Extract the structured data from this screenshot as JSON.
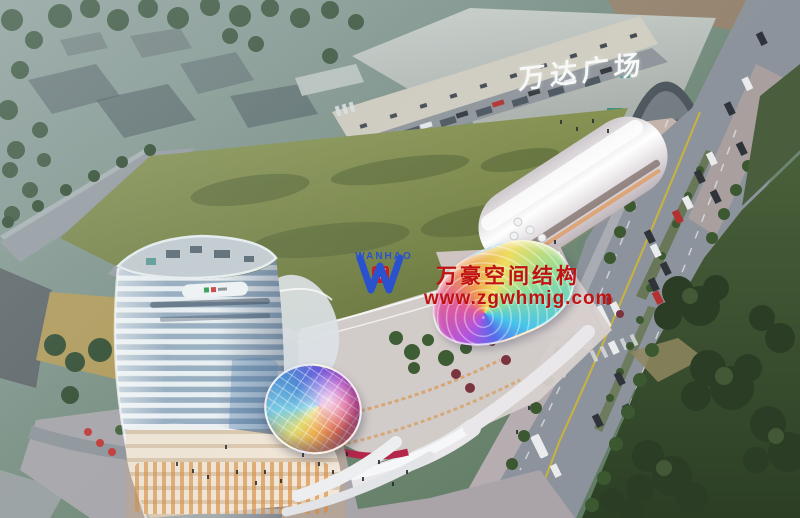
{
  "scene": {
    "description": "Dusk aerial architectural rendering: curved high-rise tower and terraced retail complex with rainbow glass dome and fan canopy, large green field, tree-lined boulevard with buses and cars, Wanda Plaza mall in background"
  },
  "mall": {
    "sign": "万达广场"
  },
  "watermark": {
    "logo_letter": "W",
    "logo_badge": "万",
    "logo_name": "WANHAO",
    "company": "万豪空间结构",
    "website": "www.zgwhmjg.com"
  },
  "colors": {
    "watermark_red": "#c01212",
    "logo_blue": "#2a52cf",
    "badge_red": "#cf1d1d",
    "field_green": "#7f8c4a",
    "lawn_dark": "#35482b",
    "road_gray": "#8d939c",
    "mall_roof": "#c2c7c3",
    "tower_stripe_light": "#edf3f7",
    "tower_stripe_shade": "#96adc2",
    "podium_glow": "#d88a3c",
    "canopy_rainbow": [
      "#e25a96",
      "#ee9a4c",
      "#eedd60",
      "#8cdc9c",
      "#46c4ec",
      "#5868ea",
      "#ae54e0"
    ],
    "dome_rainbow": [
      "#e06a48",
      "#eeb04e",
      "#e4dc6e",
      "#79cce4",
      "#4b8ed6",
      "#6659de",
      "#b048ce",
      "#de4a8e"
    ]
  }
}
